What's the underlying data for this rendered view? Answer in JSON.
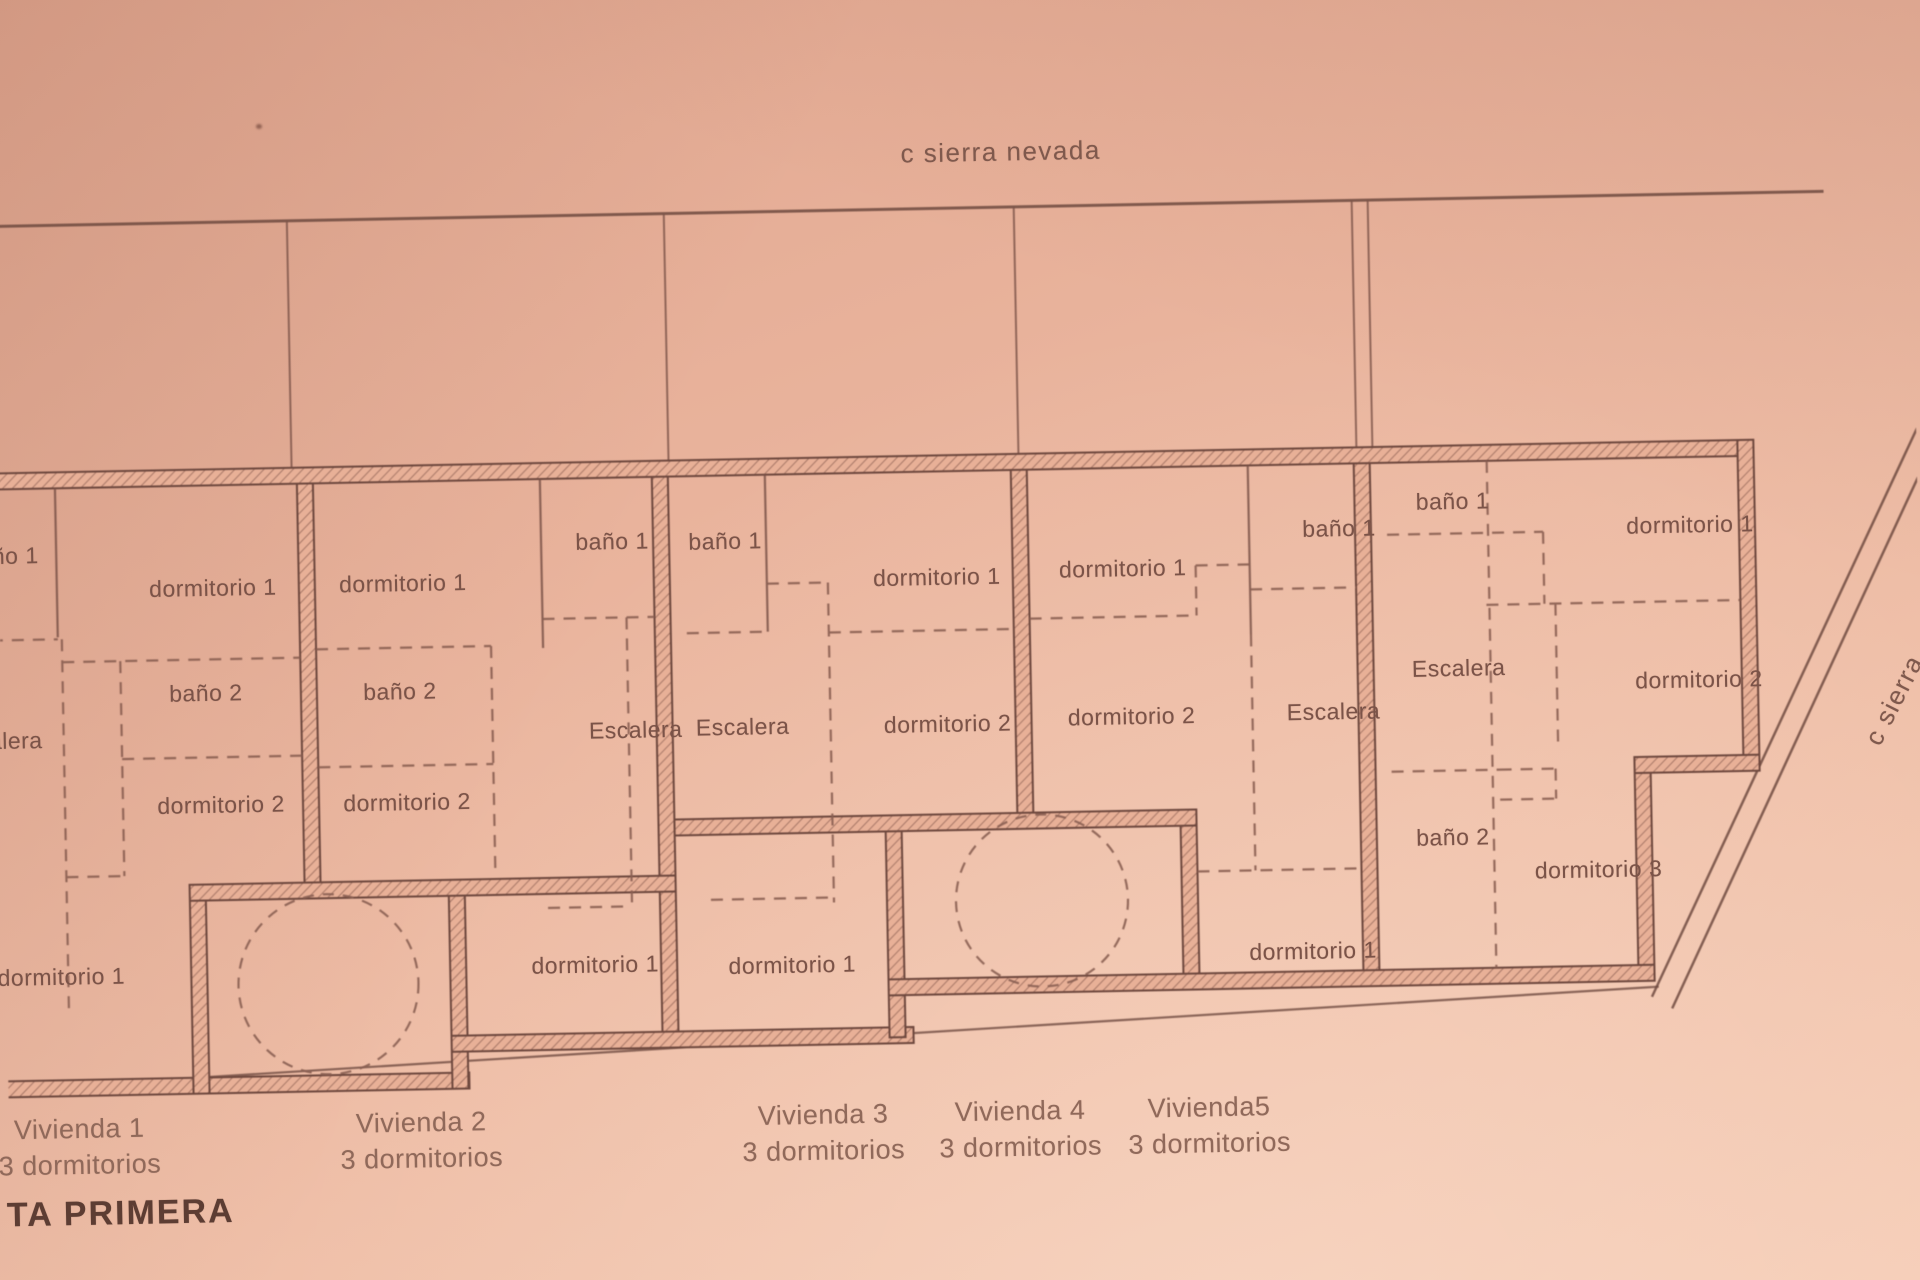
{
  "streets": {
    "top": "c sierra nevada",
    "right": "c sierra"
  },
  "plan_label": "TA PRIMERA",
  "colors": {
    "paper": "#eebaa3",
    "ink": "#7b5348",
    "wall_hatch": "#96685a"
  },
  "rooms": {
    "v1": {
      "bano1": "ño 1",
      "dorm1": "dormitorio 1",
      "bano2": "baño 2",
      "escalera": "alera",
      "dorm2": "dormitorio 2",
      "dorm1_lower": "dormitorio 1"
    },
    "v2": {
      "dorm1": "dormitorio 1",
      "bano1": "baño 1",
      "bano2": "baño 2",
      "escalera": "Escalera",
      "dorm2": "dormitorio 2",
      "dorm1_lower": "dormitorio 1"
    },
    "v3": {
      "bano1": "baño 1",
      "dorm1": "dormitorio 1",
      "escalera": "Escalera",
      "dorm2": "dormitorio 2",
      "dorm1_lower": "dormitorio 1"
    },
    "v4": {
      "dorm1": "dormitorio 1",
      "bano1": "baño 1",
      "escalera": "Escalera",
      "dorm2": "dormitorio 2",
      "dorm1_lower": "dormitorio 1"
    },
    "v5": {
      "bano1": "baño 1",
      "dorm1": "dormitorio 1",
      "escalera": "Escalera",
      "dorm2": "dormitorio 2",
      "bano2": "baño 2",
      "dorm3": "dormitorio 3"
    }
  },
  "viviendas": [
    {
      "name": "Vivienda 1",
      "bedrooms": "3 dormitorios"
    },
    {
      "name": "Vivienda 2",
      "bedrooms": "3 dormitorios"
    },
    {
      "name": "Vivienda 3",
      "bedrooms": "3 dormitorios"
    },
    {
      "name": "Vivienda 4",
      "bedrooms": "3 dormitorios"
    },
    {
      "name": "Vivienda5",
      "bedrooms": "3 dormitorios"
    }
  ]
}
